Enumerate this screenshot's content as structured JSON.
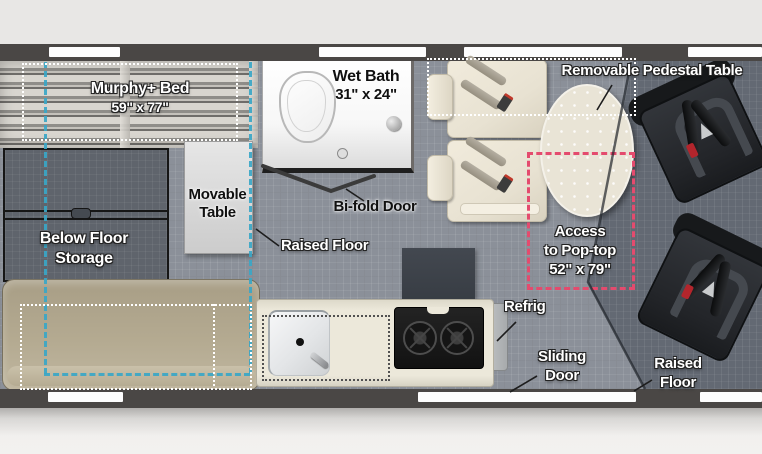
{
  "diagram_type": "rv-camper-van-floor-plan",
  "areas": {
    "murphy_bed": {
      "line1": "Murphy+ Bed",
      "line2": "59\" x 77\""
    },
    "wet_bath": {
      "line1": "Wet Bath",
      "line2": "31\" x 24\""
    },
    "removable_pedestal_table": {
      "label": "Removable Pedestal Table"
    },
    "movable_table": {
      "line1": "Movable",
      "line2": "Table"
    },
    "bifold_door": {
      "label": "Bi-fold Door"
    },
    "raised_floor_mid": {
      "label": "Raised Floor"
    },
    "below_floor_storage": {
      "line1": "Below Floor",
      "line2": "Storage"
    },
    "access_pop_top": {
      "line1": "Access",
      "line2": "to Pop-top",
      "line3": "52\" x 79\""
    },
    "refrig": {
      "label": "Refrig"
    },
    "sliding_door": {
      "line1": "Sliding",
      "line2": "Door"
    },
    "raised_floor_front": {
      "line1": "Raised",
      "line2": "Floor"
    }
  },
  "colors": {
    "teal_guide": "#3aa7c7",
    "pink_guide": "#e44b6e",
    "wall": "#4a4745",
    "floor_main": "#8b9099",
    "floor_cab": "#636973",
    "counter": "#ece8da",
    "sofa": "#b4aa91",
    "seat": "#e8e2d2",
    "captain_chair": "#232529"
  }
}
